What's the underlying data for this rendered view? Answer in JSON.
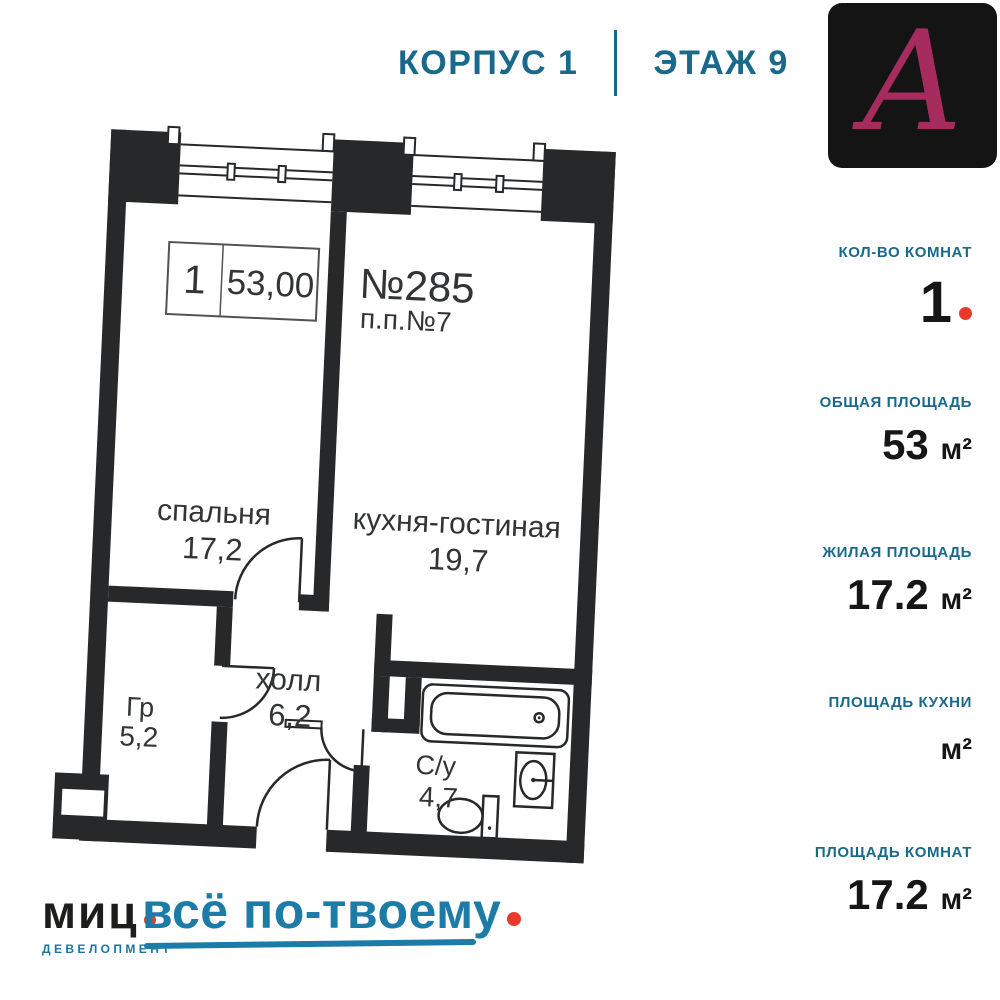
{
  "header": {
    "building": "КОРПУС 1",
    "floor": "ЭТАЖ 9"
  },
  "logo": {
    "letter": "А"
  },
  "stats": [
    {
      "label": "КОЛ-ВО КОМНАТ",
      "number": "1",
      "unit": ""
    },
    {
      "label": "ОБЩАЯ ПЛОЩАДЬ",
      "number": "53 ",
      "unit": "м²"
    },
    {
      "label": "ЖИЛАЯ ПЛОЩАДЬ",
      "number": "17.2 ",
      "unit": "м²"
    },
    {
      "label": "ПЛОЩАДЬ КУХНИ",
      "number": "",
      "unit": "м²"
    },
    {
      "label": "ПЛОЩАДЬ КОМНАТ",
      "number": "17.2 ",
      "unit": "м²"
    }
  ],
  "plan": {
    "info_box": {
      "rooms": "1",
      "area": "53,00"
    },
    "apartment": {
      "number": "№285",
      "pp": "п.п.№7"
    },
    "rooms": {
      "bedroom": {
        "name": "спальня",
        "area": "17,2"
      },
      "kitchen": {
        "name": "кухня-гостиная",
        "area": "19,7"
      },
      "hall": {
        "name": "холл",
        "area": "6,2"
      },
      "wardrobe": {
        "name": "Гр",
        "area": "5,2"
      },
      "bathroom": {
        "name": "С/у",
        "area": "4,7"
      }
    }
  },
  "branding": {
    "company": "миц",
    "division": "ДЕВЕЛОПМЕНТ",
    "slogan": "всё по-твоему"
  },
  "colors": {
    "teal": "#19698a",
    "slogan_blue": "#1d7ba8",
    "accent_red": "#e8392c",
    "wall": "#26282a",
    "logo_letter": "#a52c5c",
    "logo_bg": "#141414"
  }
}
